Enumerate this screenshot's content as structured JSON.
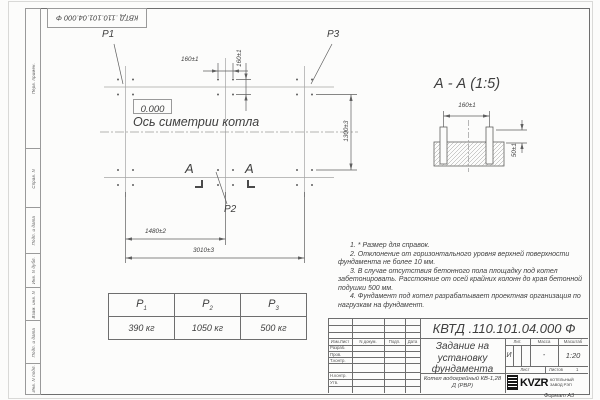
{
  "doc": {
    "number_stamp": "КВТД .110.101.04.000  Ф",
    "format": "Формат А3"
  },
  "side_strip": {
    "items": [
      "Перв. примен.",
      "Справ. N",
      "Подп. и дата",
      "Инв. N дубл.",
      "Взам. инв. N",
      "Подп. и дата",
      "Инв. N подл."
    ]
  },
  "plan": {
    "p1": "P1",
    "p2": "P2",
    "p3": "P3",
    "zero_level": "0.000",
    "axis_label": "Ось симетрии котла",
    "section_letter": "А",
    "dim_160_h": "160±1",
    "dim_160_v": "160±1",
    "dim_1300": "1300±3",
    "dim_1480": "1480±2",
    "dim_3010": "3010±3"
  },
  "section_view": {
    "title": "А - А (1:5)",
    "dim_160": "160±1",
    "dim_50": "50±1"
  },
  "notes": [
    "1. * Размер для справок.",
    "2. Отклонение от горизонтального уровня верхней поверхности фундамента не более 10 мм.",
    "3. В случае отсутствия бетонного пола площадку под котел забетонировать. Расстояние от осей крайних колонн до края бетонной подушки 500 мм.",
    "4. Фундамент под котел разрабатывает проектная организация по нагрузкам на фундамент."
  ],
  "load_table": {
    "p_base": "P",
    "subs": [
      "1",
      "2",
      "3"
    ],
    "values": [
      "390 кг",
      "1050 кг",
      "500 кг"
    ]
  },
  "title_block": {
    "number": "КВТД .110.101.04.000  Ф",
    "title": "Задание на установку фундамента",
    "product": "Котел водогрейный КВ-1,28 Д (РВР)",
    "header_izm": "Изм.Лист",
    "header_doc": "N докум.",
    "header_sign": "Подп.",
    "header_date": "Дата",
    "rows": [
      "Разраб.",
      "Пров.",
      "Т.контр.",
      "Н.контр.",
      "Утв."
    ],
    "lit_label": "Лит.",
    "mass_label": "Масса",
    "scale_label": "Масштаб",
    "lit_value": "И",
    "mass_value": "-",
    "scale_value": "1:20",
    "sheet_label": "Лист",
    "sheets_label": "Листов",
    "sheets_value": "1",
    "logo_text": "KVZR",
    "company": "КОТЕЛЬНЫЙ ЗАВОД РЭП"
  },
  "colors": {
    "ink": "#3f3f3f",
    "line": "#6e6e6e",
    "paper": "#fcfcfb"
  }
}
